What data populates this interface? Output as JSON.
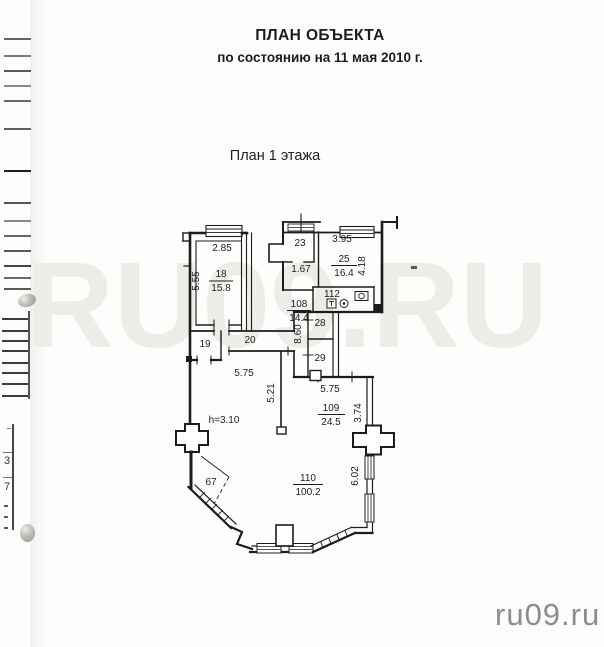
{
  "document": {
    "title": "ПЛАН ОБЪЕКТА",
    "subtitle": "по состоянию на 11 мая 2010 г.",
    "section_title": "План 1 этажа"
  },
  "watermark": {
    "center_text": "RU09.RU",
    "corner_text": "ru09.ru"
  },
  "colors": {
    "ink": "#1c1c1c",
    "watermark_center": "#edece8",
    "watermark_corner": "#8d8d8d",
    "paper": "#fdfdfb"
  },
  "margin_fragment": {
    "value_top": "3",
    "value_bottom": "7"
  },
  "plan": {
    "rooms": {
      "r18": {
        "number": "18",
        "area": "15.8"
      },
      "r25": {
        "number": "25",
        "area": "16.4"
      },
      "r108": {
        "number": "108",
        "area": "14.4"
      },
      "r109": {
        "number": "109",
        "area": "24.5"
      },
      "r110": {
        "number": "110",
        "area": "100.2"
      }
    },
    "room_numbers": {
      "r23": "23",
      "r112": "112",
      "r28": "28",
      "r29": "29",
      "r19": "19",
      "r20": "20",
      "r67": "67"
    },
    "dimensions": {
      "top_left_width": "2.85",
      "top_left_height": "5.55",
      "hall_width": "1.67",
      "top_right_width": "3.95",
      "top_right_height": "4.18",
      "corridor_height": "8.60",
      "corridor_width": "5.75",
      "hall_height": "5.21",
      "mid_width": "5.75",
      "mid_height": "3.74",
      "right_height": "6.02",
      "ceiling_height": "h=3.10"
    }
  }
}
